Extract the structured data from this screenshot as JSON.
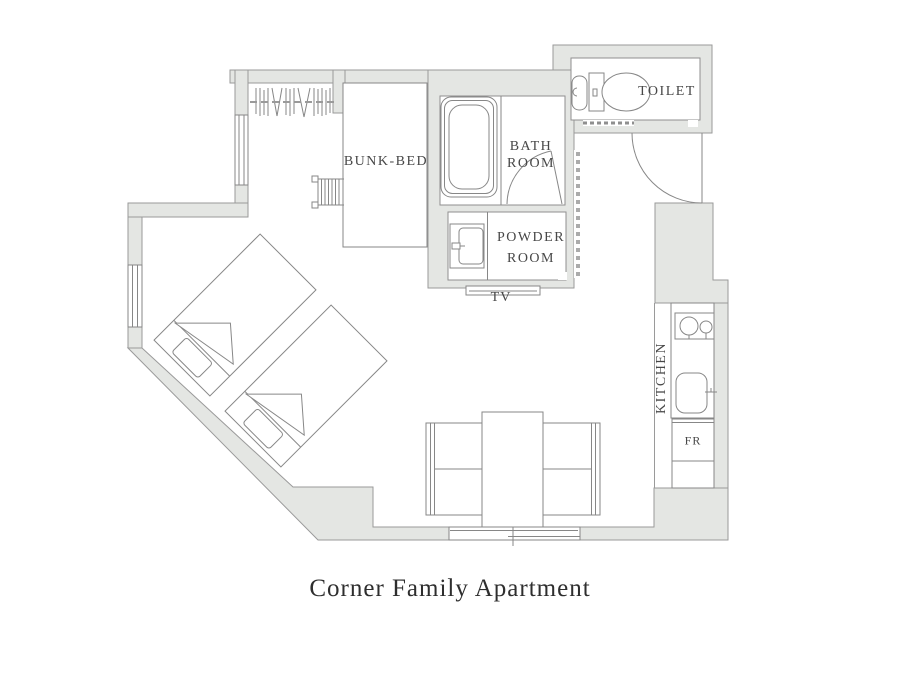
{
  "title": "Corner Family Apartment",
  "plan_labels": {
    "bunk_bed": "BUNK-BED",
    "toilet": "TOILET",
    "bath_room": [
      "BATH",
      "ROOM"
    ],
    "powder_room": [
      "POWDER",
      "ROOM"
    ],
    "tv": "TV",
    "kitchen": "KITCHEN",
    "fridge": "FR"
  },
  "colors": {
    "wall_fill": "#e4e6e3",
    "wall_stroke": "#9a9a9a",
    "fixture_line": "#878787",
    "label_text": "#474747",
    "title_text": "#2e2e2e",
    "background": "#ffffff"
  }
}
